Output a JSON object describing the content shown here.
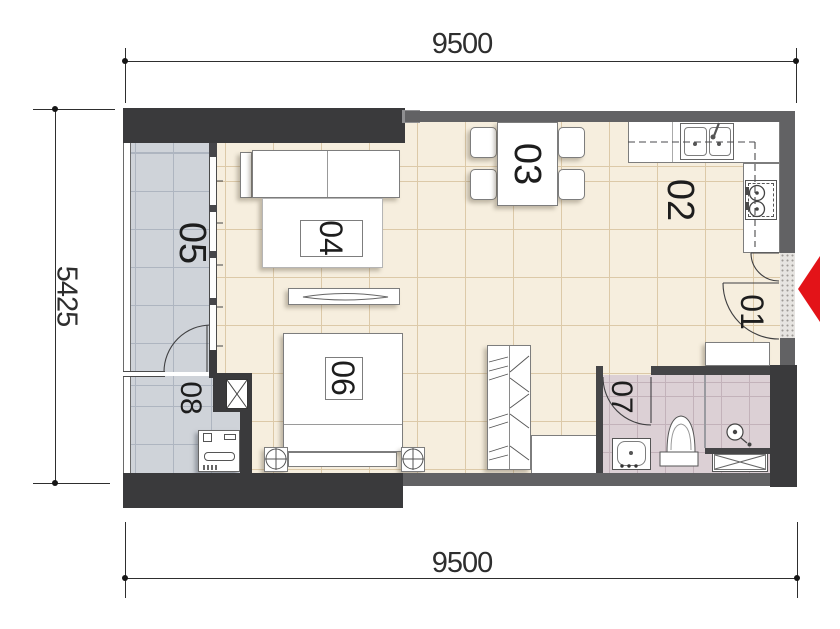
{
  "plan": {
    "dimensions": {
      "top": "9500",
      "bottom": "9500",
      "left": "5425"
    },
    "rooms": {
      "r01": {
        "label": "01"
      },
      "r02": {
        "label": "02"
      },
      "r03": {
        "label": "03"
      },
      "r04": {
        "label": "04"
      },
      "r05": {
        "label": "05"
      },
      "r06": {
        "label": "06"
      },
      "r07": {
        "label": "07"
      },
      "r08": {
        "label": "08"
      }
    },
    "icons": [
      "entrance-arrow-icon",
      "door-swing-icon",
      "sink-icon",
      "stove-icon",
      "dining-table-icon",
      "sofa-icon",
      "tv-icon",
      "bed-icon",
      "lamp-icon",
      "wardrobe-icon",
      "washer-icon",
      "toilet-icon",
      "shower-icon",
      "column-icon"
    ]
  },
  "colors": {
    "wall-dark": "#3a3a3c",
    "wall-gray": "#626264",
    "wall-step": "#8f8f91",
    "floor-main": "#f6eede",
    "floor-main-line": "#dcc9a8",
    "floor-cool": "#cfd3d9",
    "floor-cool-line": "#aeb5c0",
    "floor-bath": "#dcd0d5",
    "floor-bath-line": "#c3b2ba",
    "line": "#3f3f41",
    "dim": "#2e2e2e",
    "arrow-red": "#e31318",
    "furn": "#7d7d7d"
  }
}
